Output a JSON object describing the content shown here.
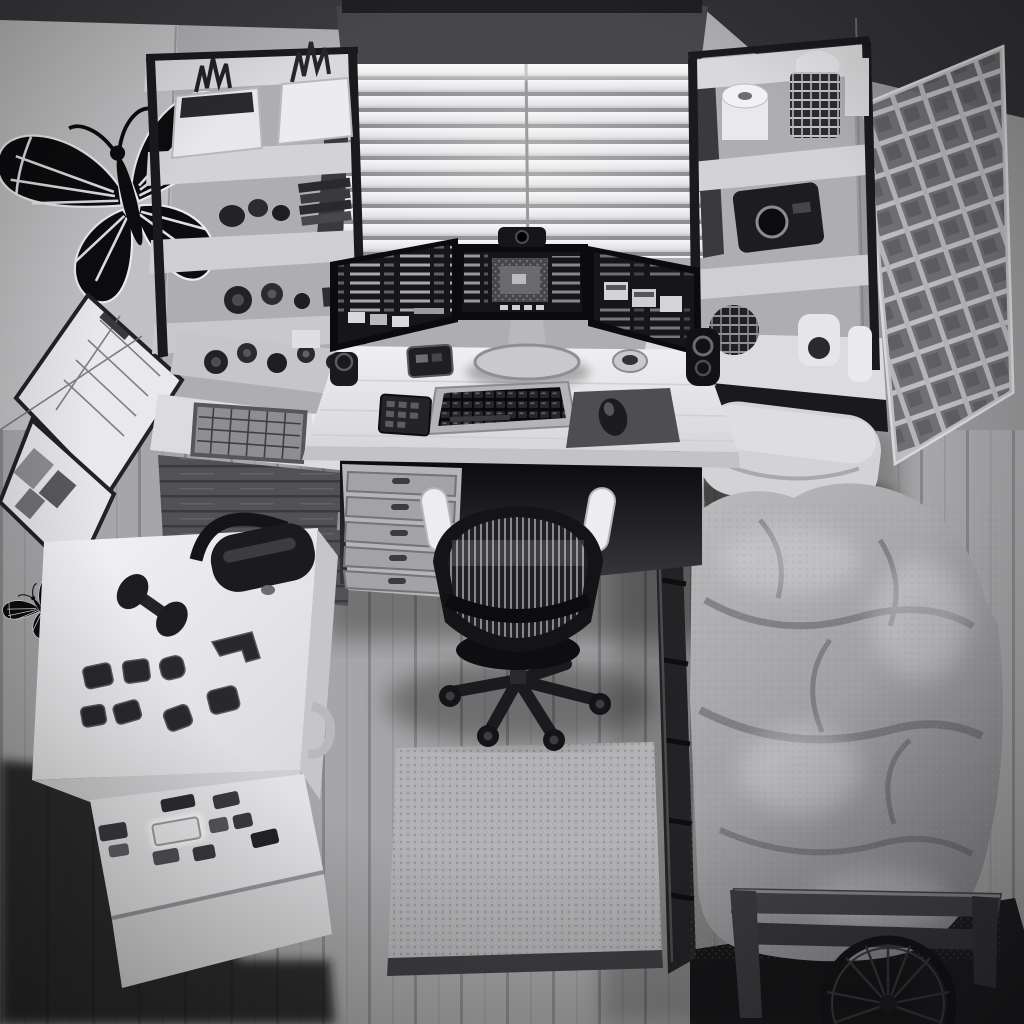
{
  "meta": {
    "alt": "Monochrome top-down render of a small bedroom office: window with white blinds, triple-monitor desk, mesh office chair, wall shelves, butterfly wall decals, mini fridge with magnets and headset, bed with gray comforter, wire grid wall panel, bicycle wheel"
  },
  "palette": {
    "wall_back": "#aeaeb0",
    "wall_left": "#c1c1c3",
    "wall_right": "#98989a",
    "ceiling": "#3a3a3d",
    "valance": "#47474b",
    "blind_gap": "#9b9b9e",
    "frame_black": "#1a1a1d",
    "board": "#d9d9db",
    "desk": "#e7e7e9",
    "bezel": "#0b0b0d",
    "screen": "#15151a",
    "key_base": "#b4b4b6",
    "pad": "#4e4e52",
    "chair": "#141417",
    "armrest": "#ededef",
    "floor": "#a6a6a8",
    "plank_line": "#87878a",
    "mat": "#b2b2b4",
    "mat_edge": "#3e3e42",
    "fridge_top": "#f0f0f2",
    "fridge_front": "#e2e2e4",
    "fridge_side": "#c6c6c8",
    "comforter": "#a4a4a6",
    "pillow": "#d3d3d5",
    "sheet": "#dedee0",
    "bed_rail": "#232326",
    "footboard": "#434347",
    "butterfly": "#0c0c0e",
    "vein": "#ececee",
    "grid_line": "#d8d8da"
  },
  "room": {
    "window": {
      "label": "window with white venetian blinds",
      "valance": "dark valance"
    },
    "walls": {
      "left": "light gray wall",
      "back": "gray wall",
      "right": "darker gray wall"
    },
    "floor": {
      "label": "gray wood plank floor"
    }
  },
  "decor": {
    "butterfly_large": {
      "label": "large black butterfly decal"
    },
    "butterfly_medium": {
      "label": "medium butterfly decal"
    },
    "butterfly_small": {
      "label": "small butterfly decal"
    },
    "poster_calendar": {
      "label": "framed calendar chart"
    },
    "poster_photos": {
      "label": "framed photo collage"
    },
    "wire_grid_panel": {
      "label": "metal wire grid wall panel"
    }
  },
  "shelves": {
    "left_unit": {
      "label": "black frame shelf unit",
      "items": [
        "white planter with dried plant",
        "white bin with dark plant",
        "dark knick-knacks",
        "stack of dark books",
        "round cameras"
      ]
    },
    "right_unit": {
      "label": "black frame shelf unit",
      "items": [
        "toilet paper roll",
        "patterned canister",
        "black camera device",
        "patterned sphere",
        "white webcam device",
        "white bottle"
      ]
    }
  },
  "workstation": {
    "desk": {
      "label": "white corner desk"
    },
    "monitor_left": {
      "label": "left monitor with code"
    },
    "monitor_center": {
      "label": "center monitor with photo window"
    },
    "monitor_right": {
      "label": "right monitor with panels"
    },
    "webcam": {
      "label": "webcam on center monitor"
    },
    "keyboard": {
      "label": "black keyboard on silver tray"
    },
    "mouse": {
      "label": "black mouse"
    },
    "mousepad": {
      "label": "dark mousepad"
    },
    "speaker_left": {
      "label": "left speaker"
    },
    "speaker_right": {
      "label": "black cylinder speaker"
    },
    "puck_device": {
      "label": "round dial device"
    },
    "calculator": {
      "label": "small black keypad device"
    },
    "hub_device": {
      "label": "black box device"
    },
    "drawer_unit": {
      "label": "five-drawer pedestal"
    },
    "side_cabinet": {
      "label": "rustic wood cabinet"
    },
    "grid_tray": {
      "label": "grid keypad tray"
    },
    "papers": {
      "label": "papers with sunglasses"
    },
    "chair": {
      "label": "black mesh office chair with white armrests"
    },
    "floor_mat": {
      "label": "textured chair mat"
    }
  },
  "fridge": {
    "label": "white mini fridge",
    "top_items": [
      "black over-ear headset",
      "black dumbbell",
      "eight black magnet trinkets"
    ],
    "front": {
      "stickers": "magnet stickers",
      "glow_sticker": "glowing white sticker"
    },
    "handle": "side door handle"
  },
  "bed": {
    "label": "single bed along right wall",
    "pillow": "light gray pillow",
    "comforter": "rumpled gray comforter",
    "rail": "dark wood side rail",
    "footboard": "dark wood footboard",
    "wheel": "bicycle wheel behind footboard"
  }
}
